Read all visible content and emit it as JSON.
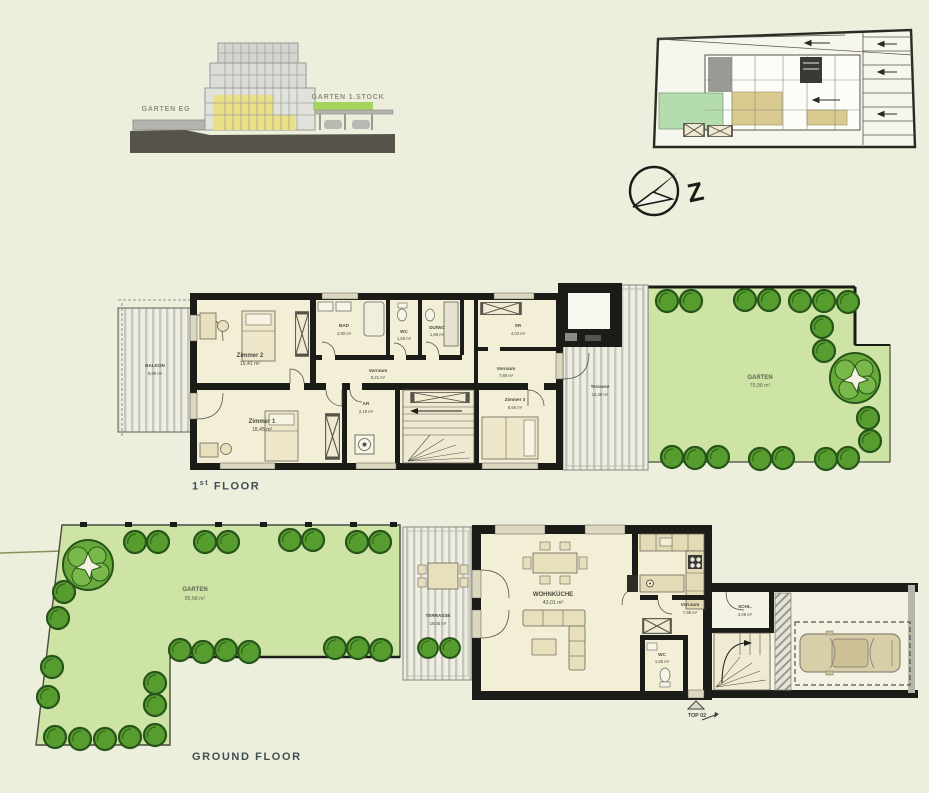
{
  "elevation": {
    "garten_eg": "GARTEN EG",
    "garten_stock": "GARTEN 1.STOCK"
  },
  "compass": {
    "north_letter": "Z"
  },
  "first_floor": {
    "title_num": "1",
    "title_sup": "st",
    "title_text": "FLOOR",
    "rooms": {
      "balkon": {
        "name": "BALKON",
        "area": "9,98 m²"
      },
      "zimmer2": {
        "name": "Zimmer 2",
        "area": "15,41 m²"
      },
      "zimmer1": {
        "name": "Zimmer 1",
        "area": "18,45 m²"
      },
      "bad": {
        "name": "BAD",
        "area": "4,90 m²"
      },
      "wc": {
        "name": "WC",
        "area": "1,65 m²"
      },
      "duwc": {
        "name": "DU/WC",
        "area": "1,88 m²"
      },
      "sr": {
        "name": "SR",
        "area": "4,04 m²"
      },
      "vorraum1": {
        "name": "Vorraum",
        "area": "9,21 m²"
      },
      "vorraum2": {
        "name": "Vorraum",
        "area": "7,89 m²"
      },
      "zimmer3": {
        "name": "Zimmer 3",
        "area": "8,66 m²"
      },
      "ar": {
        "name": "AR",
        "area": "2,18 m²"
      },
      "terrasse": {
        "name": "Terrasse",
        "area": "14,38 m²"
      },
      "garten": {
        "name": "GARTEN",
        "area": "75,98 m²"
      }
    }
  },
  "ground_floor": {
    "title": "GROUND FLOOR",
    "entrance": "TOP 02",
    "rooms": {
      "garten": {
        "name": "GARTEN",
        "area": "85,68 m²"
      },
      "terrasse": {
        "name": "TERRASSE",
        "area": "16,05 m²"
      },
      "wohnkueche": {
        "name": "WOHNKÜCHE",
        "area": "43,01 m²"
      },
      "vorraum": {
        "name": "Vorraum",
        "area": "7,95 m²"
      },
      "wc": {
        "name": "WC",
        "area": "1,65 m²"
      },
      "schl": {
        "name": "SCHL.",
        "area": "3,08 m²"
      }
    }
  },
  "colors": {
    "background": "#ecefdc",
    "room_fill": "#f3eed6",
    "wall_dark": "#1b1b18",
    "garden_green": "#cde4a5",
    "bush_green": "#569c2e",
    "elevation_highlight_yellow": "#e9df85",
    "elevation_garden_bar_green": "#a6d45f",
    "site_plan_green": "#b5dcae",
    "site_plan_unit_tan": "#d9ca8f"
  }
}
